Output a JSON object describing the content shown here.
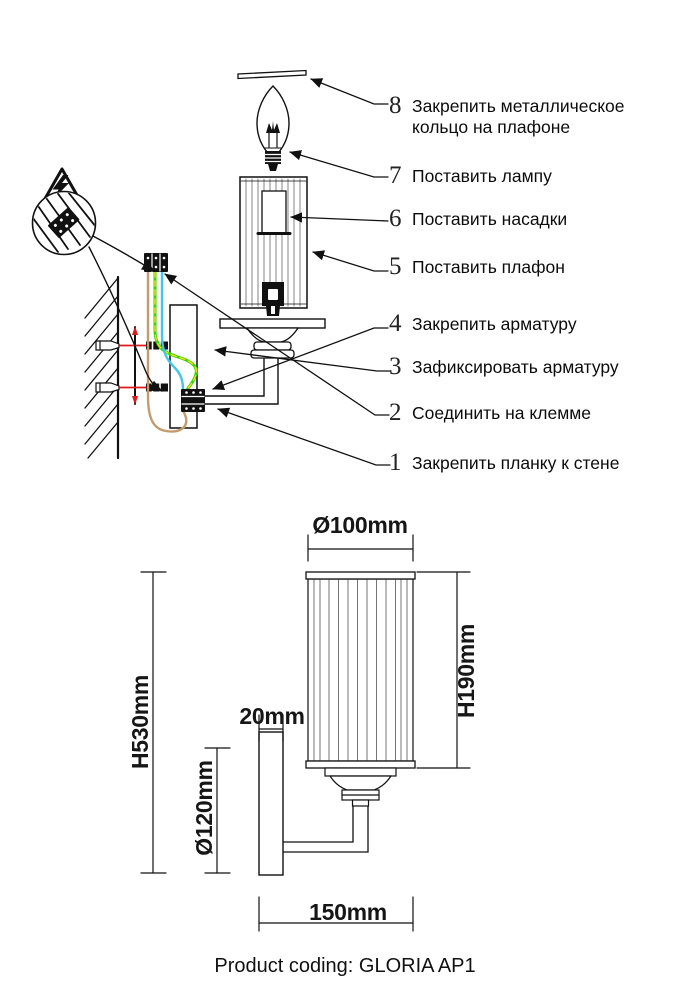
{
  "assembly": {
    "steps": [
      {
        "num": "1",
        "label": "Закрепить планку к стене"
      },
      {
        "num": "2",
        "label": "Соединить на клемме"
      },
      {
        "num": "3",
        "label": "Зафиксировать арматуру"
      },
      {
        "num": "4",
        "label": "Закрепить арматуру"
      },
      {
        "num": "5",
        "label": "Поставить плафон"
      },
      {
        "num": "6",
        "label": "Поставить насадки"
      },
      {
        "num": "7",
        "label": "Поставить лампу"
      },
      {
        "num": "8",
        "label": "Закрепить металлическое кольцо на плафоне"
      }
    ]
  },
  "dimension_drawing": {
    "shade_diameter": "Ø100mm",
    "shade_height": "H190mm",
    "overall_height": "H530mm",
    "backplate_width": "20mm",
    "backplate_height": "Ø120mm",
    "arm_projection": "150mm"
  },
  "footer": {
    "product_coding": "Product coding: GLORIA AP1"
  },
  "colors": {
    "wire_brown": "#c59a6d",
    "wire_green": "#35d60a",
    "wire_yellow": "#f5e000",
    "wire_blue": "#41c7ee",
    "marking_red": "#e01b1b",
    "line": "#111111"
  }
}
